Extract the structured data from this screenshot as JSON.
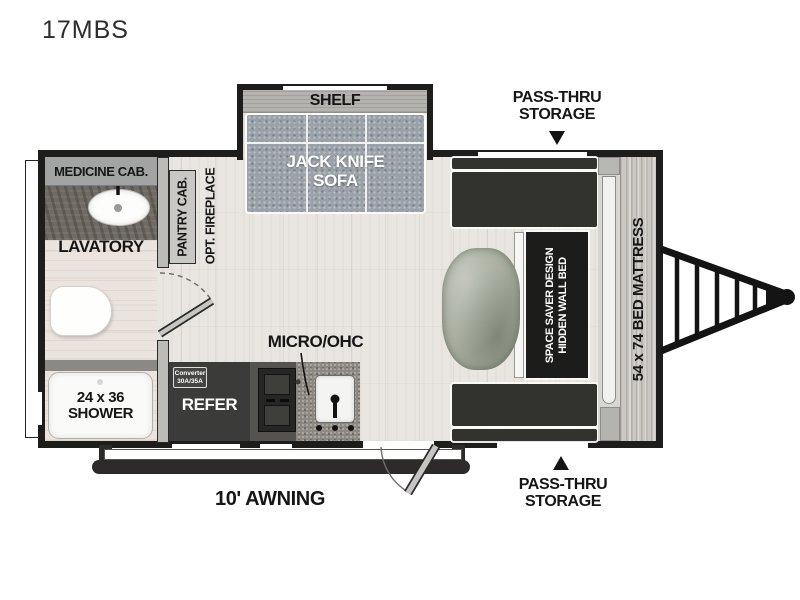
{
  "model": "17MBS",
  "colors": {
    "wall": "#1d1d1b",
    "floor": "#e9e6e1",
    "bath_floor": "#ebe3dd",
    "sofa": "#9aa1a8",
    "dark_cabinet": "#32322e",
    "refer": "#3b3b39",
    "counter": "#8d8982",
    "label_text": "#161616"
  },
  "callouts": {
    "pass_thru_top": {
      "line1": "PASS-THRU",
      "line2": "STORAGE"
    },
    "pass_thru_bottom": {
      "line1": "PASS-THRU",
      "line2": "STORAGE"
    },
    "awning": "10' AWNING",
    "micro": "MICRO/OHC"
  },
  "living_area": {
    "shelf": "SHELF",
    "sofa": {
      "line1": "JACK KNIFE",
      "line2": "SOFA"
    }
  },
  "bedroom": {
    "mattress": "54 x 74 BED MATTRESS",
    "wall_bed": {
      "line1": "SPACE SAVER DESIGN",
      "line2": "HIDDEN WALL BED"
    }
  },
  "bathroom": {
    "medicine_cab": "MEDICINE CAB.",
    "lavatory": "LAVATORY",
    "shower": {
      "line1": "24 x 36",
      "line2": "SHOWER"
    }
  },
  "kitchen": {
    "pantry": "PANTRY CAB.",
    "fireplace": "OPT. FIREPLACE",
    "refer": "REFER",
    "converter": {
      "line1": "Converter",
      "line2": "30A/35A"
    }
  }
}
